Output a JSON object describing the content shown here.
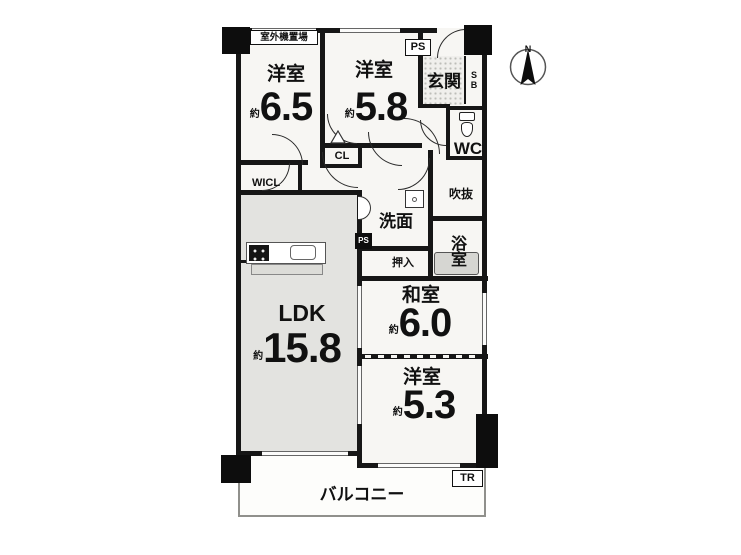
{
  "rooms": {
    "yoshitsu_65": {
      "label": "洋室",
      "approx": "約",
      "area": "6.5"
    },
    "yoshitsu_58": {
      "label": "洋室",
      "approx": "約",
      "area": "5.8"
    },
    "ldk": {
      "label": "LDK",
      "approx": "約",
      "area": "15.8"
    },
    "washitsu_60": {
      "label": "和室",
      "approx": "約",
      "area": "6.0"
    },
    "yoshitsu_53": {
      "label": "洋室",
      "approx": "約",
      "area": "5.3"
    },
    "genkan_label": "玄関",
    "wc_label": "WC",
    "senmen_label": "洗面",
    "bath_label": "浴室",
    "oshiire_label": "押入",
    "fukinuke_label": "吹抜",
    "balcony_label": "バルコニー",
    "wicl_label": "WICL",
    "cl_label": "CL"
  },
  "annotations": {
    "outdoor_unit": "室外機置場",
    "ps_top": "PS",
    "ps_small": "PS",
    "shoe_box": "SB",
    "trunk_room": "TR",
    "compass_north": "N"
  },
  "colors": {
    "wall": "#161616",
    "room_fill": "#f7f6f3",
    "ldk_fill": "#e3e3e0",
    "tub_fill": "#d6d6d2",
    "balcony_border": "#90908c"
  }
}
